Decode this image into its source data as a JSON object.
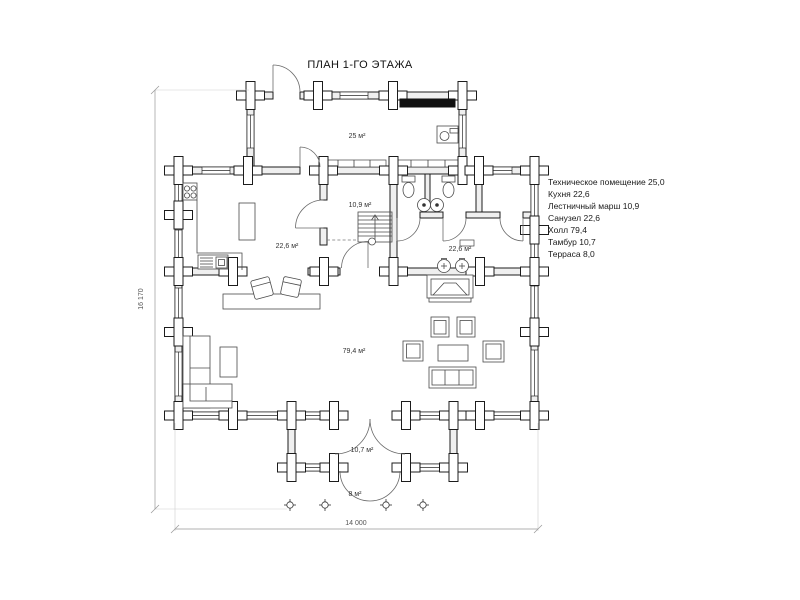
{
  "title": "ПЛАН 1-ГО ЭТАЖА",
  "legend_items": [
    "Техническое помещение 25,0",
    "Кухня 22,6",
    "Лестничный марш 10,9",
    "Санузел 22,6",
    "Холл 79,4",
    "Тамбур 10,7",
    "Терраса 8,0"
  ],
  "room_labels": {
    "tech": "25 м²",
    "stair": "10,9 м²",
    "kitchen": "22,6 м²",
    "bathroom": "22,6 м²",
    "hall": "79,4 м²",
    "vestibule": "10,7 м²",
    "terrace": "8 м²"
  },
  "dimensions": {
    "horizontal": "14 000",
    "vertical": "16 170"
  },
  "colors": {
    "paper": "#ffffff",
    "line": "#1c1c1c",
    "wall_fill": "#efefef",
    "equipment_black": "#111111"
  }
}
